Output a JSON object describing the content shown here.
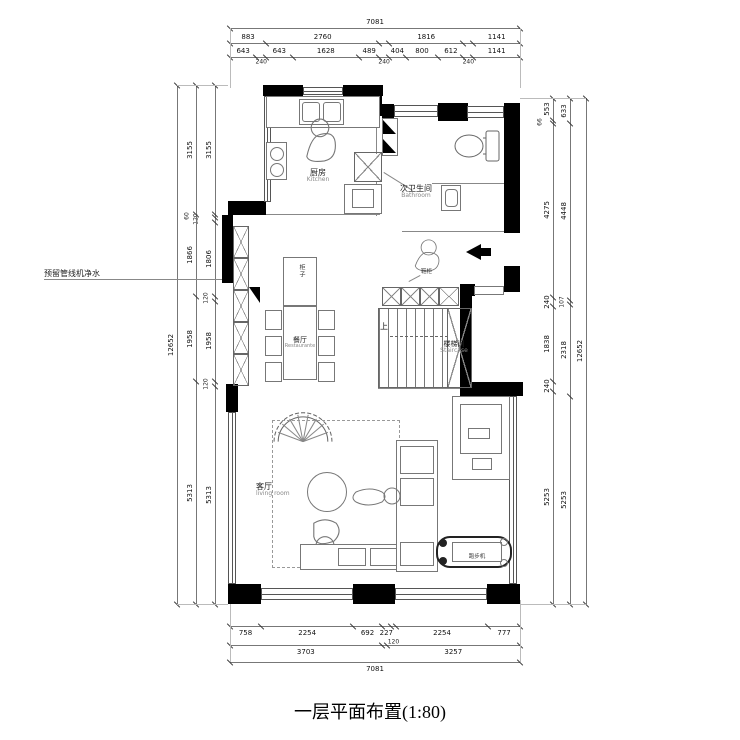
{
  "title": "一层平面布置(1:80)",
  "annotations": {
    "left_note": "预留管线机净水",
    "shoe_cabinet": "鞋柜",
    "up": "上",
    "cabinet": "柜子"
  },
  "rooms": {
    "kitchen": {
      "zh": "厨房",
      "en": "Kitchen"
    },
    "bathroom": {
      "zh": "次卫生间",
      "en": "Bathroom"
    },
    "dining": {
      "zh": "餐厅",
      "en": "Restaurante"
    },
    "staircase": {
      "zh": "楼梯间",
      "en": "Staircase"
    },
    "living": {
      "zh": "客厅",
      "en": "living room"
    },
    "treadmill": {
      "zh": "跑步机"
    }
  },
  "dimensions": {
    "top": [
      {
        "segs": [
          {
            "len": 7081
          }
        ]
      },
      {
        "segs": [
          {
            "len": 883
          },
          {
            "len": 2760
          },
          {
            "len": 240,
            "hide": true
          },
          {
            "len": 1816
          },
          {
            "len": 240,
            "hide": true
          },
          {
            "len": 1141
          }
        ]
      },
      {
        "segs": [
          {
            "len": 643
          },
          {
            "len": 240,
            "small": true
          },
          {
            "len": 643
          },
          {
            "len": 1628
          },
          {
            "len": 489
          },
          {
            "len": 240,
            "small": true
          },
          {
            "len": 404
          },
          {
            "len": 800
          },
          {
            "len": 612
          },
          {
            "len": 240,
            "small": true
          },
          {
            "len": 1141
          }
        ]
      }
    ],
    "bottom": [
      {
        "segs": [
          {
            "len": 758
          },
          {
            "len": 2254
          },
          {
            "len": 692
          },
          {
            "len": 227
          },
          {
            "len": 120,
            "small": true
          },
          {
            "len": 2254
          },
          {
            "len": 777
          }
        ]
      },
      {
        "segs": [
          {
            "len": 3703
          },
          {
            "len": 120,
            "hide": true
          },
          {
            "len": 3257
          }
        ]
      },
      {
        "segs": [
          {
            "len": 7081
          }
        ]
      }
    ],
    "left": [
      {
        "segs": [
          {
            "len": 3155
          },
          {
            "len": 60,
            "small": true,
            "dx": -22
          },
          {
            "len": 120,
            "small": true,
            "dx": -13
          },
          {
            "len": 1806
          },
          {
            "len": 120,
            "small": true,
            "dx": -3
          },
          {
            "len": 1958
          },
          {
            "len": 120,
            "small": true,
            "dx": -3
          },
          {
            "len": 5313
          }
        ]
      },
      {
        "segs": [
          {
            "len": 3155,
            "label": "3155"
          },
          {
            "len": 1986,
            "label": "1866"
          },
          {
            "len": 2078,
            "label": "1958"
          },
          {
            "len": 5433,
            "label": "5313"
          }
        ]
      },
      {
        "segs": [
          {
            "len": 12652
          }
        ]
      }
    ],
    "right": [
      {
        "segs": [
          {
            "len": 553
          },
          {
            "len": 66,
            "small": true,
            "dx": -7
          },
          {
            "len": 4275
          },
          {
            "len": 240
          },
          {
            "len": 1838
          },
          {
            "len": 240
          },
          {
            "len": 5253
          }
        ]
      },
      {
        "segs": [
          {
            "len": 633
          },
          {
            "len": 4448
          },
          {
            "len": 107,
            "small": true,
            "dx": -2
          },
          {
            "len": 2318
          },
          {
            "len": 5253
          }
        ]
      },
      {
        "segs": [
          {
            "len": 12652
          }
        ]
      }
    ]
  }
}
